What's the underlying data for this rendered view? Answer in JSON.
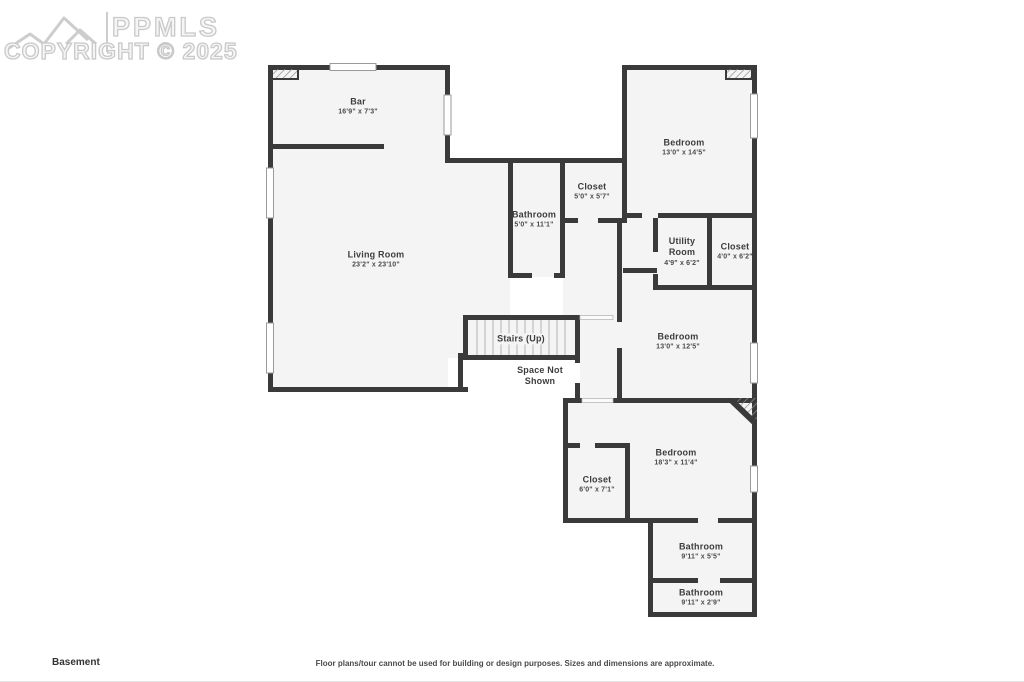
{
  "watermark": {
    "brand": "PPMLS",
    "copyright": "COPYRIGHT © 2025",
    "logo": "mountain-logo"
  },
  "floor_label": "Basement",
  "disclaimer": "Floor plans/tour cannot be used for building or design purposes. Sizes and dimensions are approximate.",
  "colors": {
    "wall": "#3a3a3a",
    "floor": "#f4f4f4",
    "background": "#ffffff",
    "watermark_outline": "#c9c9c9",
    "label_text": "#3d3d3d"
  },
  "rooms": [
    {
      "id": "bar",
      "name": "Bar",
      "dims": "16'9\" x 7'3\""
    },
    {
      "id": "living-room",
      "name": "Living Room",
      "dims": "23'2\" x 23'10\""
    },
    {
      "id": "bathroom-main",
      "name": "Bathroom",
      "dims": "5'0\" x 11'1\""
    },
    {
      "id": "closet-main",
      "name": "Closet",
      "dims": "5'0\" x 5'7\""
    },
    {
      "id": "bedroom-1",
      "name": "Bedroom",
      "dims": "13'0\" x 14'5\""
    },
    {
      "id": "utility-room",
      "name": "Utility Room",
      "dims": "4'9\" x 6'2\""
    },
    {
      "id": "closet-utility",
      "name": "Closet",
      "dims": "4'0\" x 6'2\""
    },
    {
      "id": "bedroom-2",
      "name": "Bedroom",
      "dims": "13'0\" x 12'5\""
    },
    {
      "id": "stairs",
      "name": "Stairs (Up)",
      "dims": ""
    },
    {
      "id": "space-not-shown",
      "name": "Space Not Shown",
      "dims": ""
    },
    {
      "id": "bedroom-3",
      "name": "Bedroom",
      "dims": "18'3\" x 11'4\""
    },
    {
      "id": "closet-bottom",
      "name": "Closet",
      "dims": "6'0\" x 7'1\""
    },
    {
      "id": "bathroom-lower-1",
      "name": "Bathroom",
      "dims": "9'11\" x 5'5\""
    },
    {
      "id": "bathroom-lower-2",
      "name": "Bathroom",
      "dims": "9'11\" x 2'9\""
    }
  ]
}
